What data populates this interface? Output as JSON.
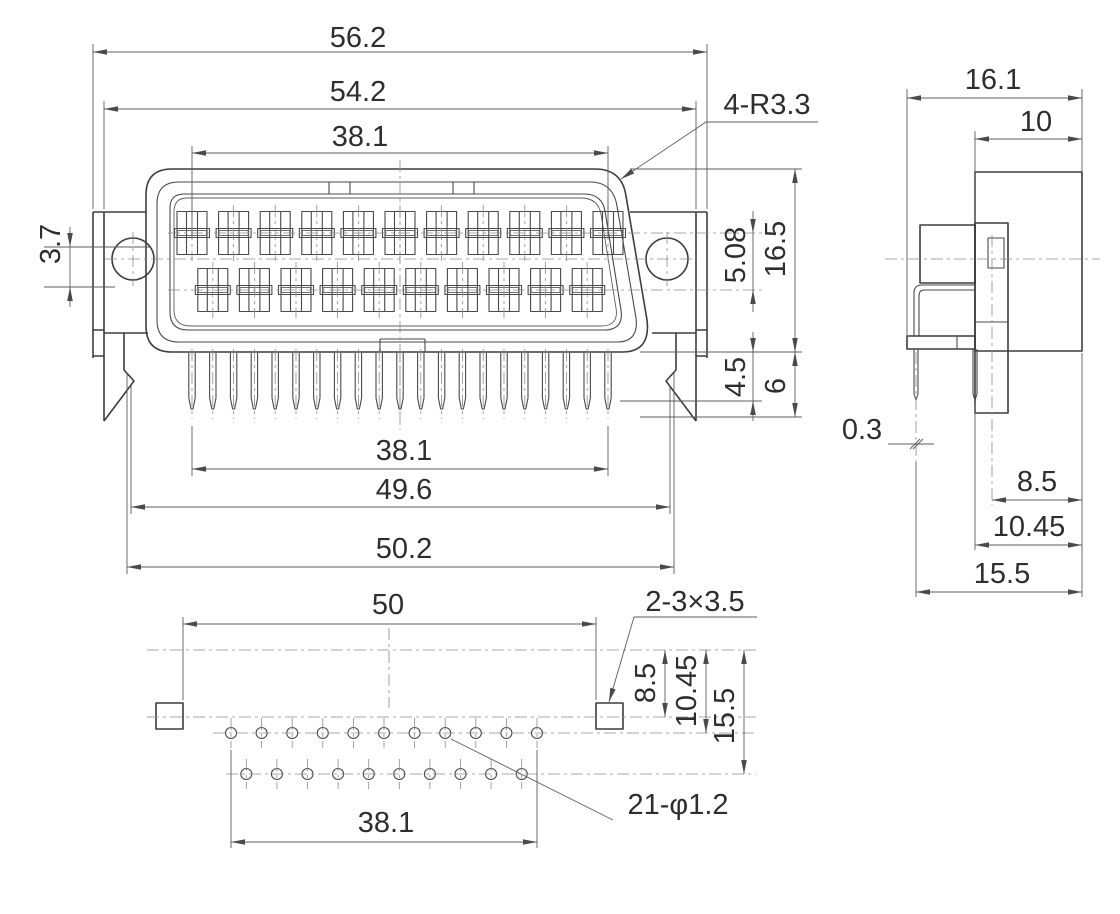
{
  "drawing": {
    "front": {
      "overall_width": "56.2",
      "body_width": "54.2",
      "contact_span": "38.1",
      "ear_offset": "3.7",
      "corner_radius": "4-R3.3",
      "row_spacing": "5.08",
      "shell_height": "16.5",
      "pin_shoulder_length": "4.5",
      "pin_length": "6",
      "pin_span": "38.1",
      "foot_span_inner": "49.6",
      "foot_span_outer": "50.2",
      "top_contact_count": 11,
      "bottom_contact_count": 10,
      "pin_count": 21
    },
    "side": {
      "overall_depth": "16.1",
      "body_depth": "10",
      "pin_offset": "0.3",
      "pin_row_a": "8.5",
      "pin_row_b": "10.45",
      "pin_row_c": "15.5"
    },
    "bottom": {
      "slot_span": "50",
      "slot_note": "2-3×3.5",
      "row_a": "8.5",
      "row_b": "10.45",
      "row_c": "15.5",
      "hole_span": "38.1",
      "hole_note": "21-φ1.2",
      "top_hole_count": 11,
      "bottom_hole_count": 10
    }
  }
}
